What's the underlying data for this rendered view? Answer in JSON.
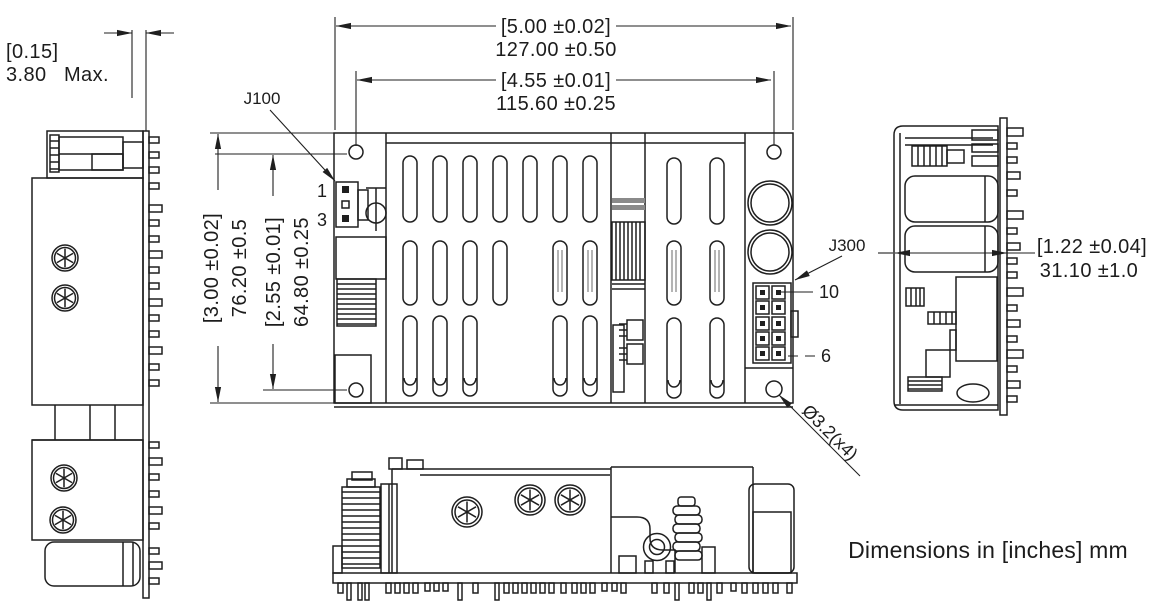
{
  "drawing": {
    "note": "Dimensions in [inches] mm",
    "dimensions": {
      "overall_width": {
        "inches": "[5.00 ±0.02]",
        "mm": "127.00 ±0.50"
      },
      "mounting_width": {
        "inches": "[4.55 ±0.01]",
        "mm": "115.60 ±0.25"
      },
      "pcb_thickness": {
        "inches": "[0.15]",
        "mm": "3.80",
        "qualifier": "Max."
      },
      "overall_depth": {
        "inches": "[3.00 ±0.02]",
        "mm": "76.20 ±0.5"
      },
      "mounting_depth": {
        "inches": "[2.55 ±0.01]",
        "mm": "64.80 ±0.25"
      },
      "overall_height": {
        "inches": "[1.22 ±0.04]",
        "mm": "31.10 ±1.0"
      },
      "mounting_holes": {
        "callout": "Ø3.2(x4)"
      }
    },
    "connectors": {
      "input": {
        "label": "J100",
        "first_pin": "1",
        "last_pin": "3"
      },
      "output": {
        "label": "J300",
        "first_pin": "10",
        "last_pin": "6"
      }
    }
  }
}
